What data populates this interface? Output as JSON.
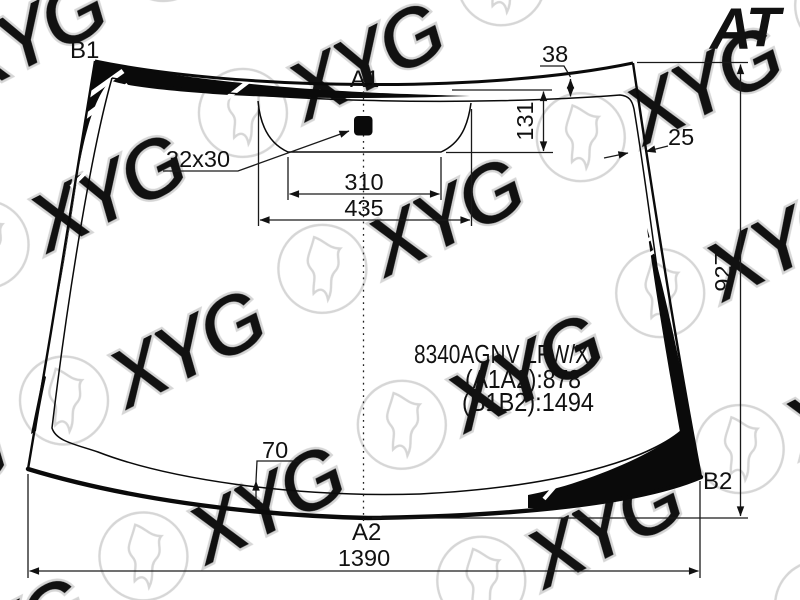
{
  "page": {
    "background": "#ffffff",
    "line_color": "#111111"
  },
  "logo": {
    "a": "A",
    "t": "T",
    "a_color": "#ed7d17",
    "t_color": "#2638b0"
  },
  "watermark": {
    "text": "XYG",
    "color": "#d6d6d6"
  },
  "labels": {
    "b1": "B1",
    "a1": "A1",
    "a2": "A2",
    "b2": "B2"
  },
  "dims": {
    "top_band": "38",
    "bracket_depth": "131",
    "right_band": "25",
    "height": "927",
    "bottom_band": "70",
    "sensor_size": "32x30",
    "bracket_inner_width": "310",
    "bracket_outer_width": "435",
    "width": "1390"
  },
  "part_info": {
    "code": "8340AGNV LFW/X",
    "a1a2": "(A1A2):878",
    "b1b2": "(B1B2):1494"
  }
}
